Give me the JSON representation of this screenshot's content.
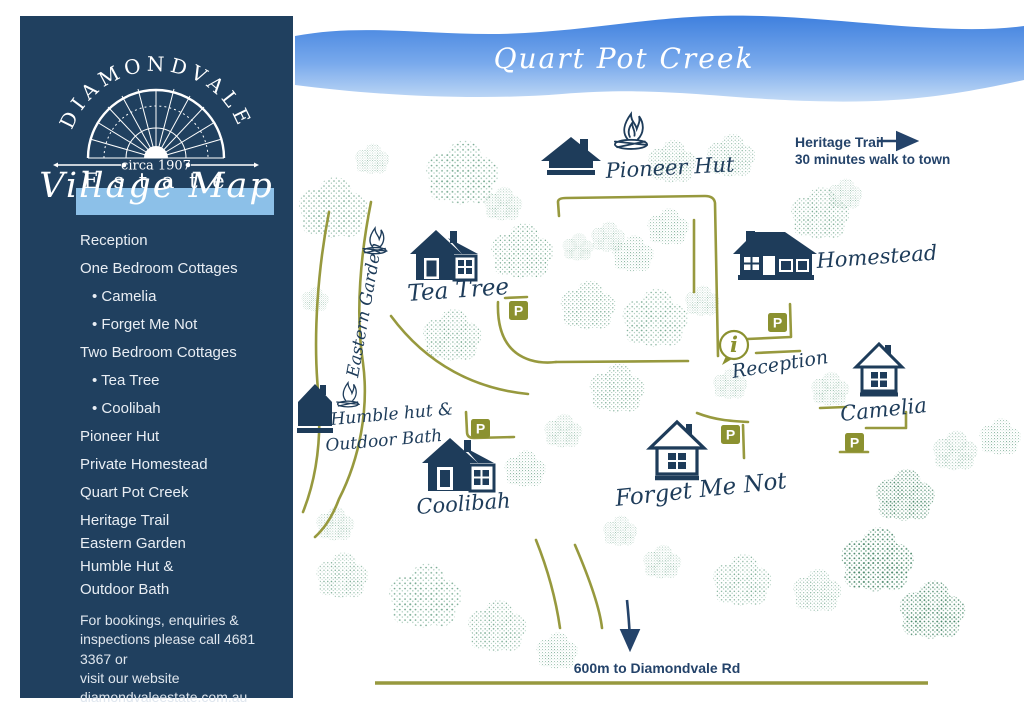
{
  "colors": {
    "navy": "#1e3c5a",
    "olive_sign": "#8b9130",
    "path_olive": "#97993e",
    "tree_light": "#8db9a4",
    "tree_dark": "#4d8a6d",
    "band_blue": "#8cc0e8",
    "creek_top": "#3f80de",
    "creek_bottom": "#b7d5f3"
  },
  "sidebar": {
    "logo": {
      "arc_text": "DIAMONDVALE",
      "circa": "circa 1907",
      "estate": "E s t a t e"
    },
    "village_map_label": "Village Map",
    "legend": [
      {
        "label": "Reception",
        "bullet": false
      },
      {
        "label": "One Bedroom Cottages",
        "bullet": false
      },
      {
        "label": "Camelia",
        "bullet": true
      },
      {
        "label": "Forget Me Not",
        "bullet": true
      },
      {
        "label": "Two Bedroom Cottages",
        "bullet": false
      },
      {
        "label": "Tea Tree",
        "bullet": true
      },
      {
        "label": "Coolibah",
        "bullet": true
      },
      {
        "label": "Pioneer Hut",
        "bullet": false
      },
      {
        "label": "Private Homestead",
        "bullet": false
      },
      {
        "label": "Quart Pot Creek",
        "bullet": false
      },
      {
        "label": "Heritage Trail",
        "bullet": false
      },
      {
        "label": "Eastern Garden",
        "bullet": false
      },
      {
        "label": "Humble Hut &",
        "bullet": false
      },
      {
        "label": "Outdoor Bath",
        "bullet": false
      }
    ],
    "footer": "For bookings, enquiries &\ninspections please call 4681 3367 or\nvisit our website\ndiamondvaleestate.com.au"
  },
  "creek": {
    "label": "Quart Pot Creek"
  },
  "map": {
    "labels": {
      "pioneer_hut": "Pioneer Hut",
      "tea_tree": "Tea Tree",
      "homestead": "Homestead",
      "reception": "Reception",
      "camelia": "Camelia",
      "forget_me_not": "Forget Me Not",
      "coolibah": "Coolibah",
      "humble_hut_line1": "Humble hut &",
      "humble_hut_line2": "Outdoor Bath",
      "eastern_garden": "Eastern Garden",
      "heritage_trail": "Heritage Trail",
      "heritage_sub": "30 minutes walk to town",
      "road": "600m to Diamondvale Rd",
      "parking": "P",
      "info": "i"
    }
  }
}
